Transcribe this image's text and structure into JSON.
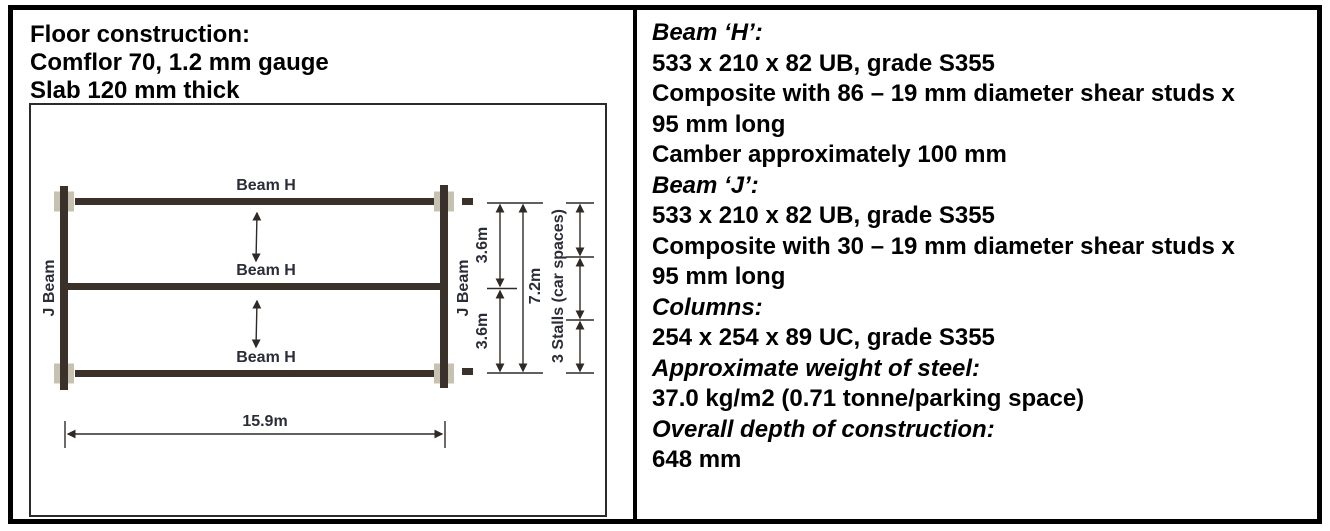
{
  "colors": {
    "beam": "#3a312a",
    "plate": "#c7c1b1",
    "line": "#2f2a26",
    "label": "#2b2e38",
    "text": "#000000"
  },
  "left_panel": {
    "header_lines": [
      "Floor construction:",
      "Comflor 70, 1.2 mm gauge",
      "Slab 120 mm thick"
    ]
  },
  "diagram": {
    "beam_h_top": "Beam H",
    "beam_h_mid": "Beam H",
    "beam_h_bottom": "Beam H",
    "j_beam_left": "J Beam",
    "j_beam_right": "J Beam",
    "dim_bay_top": "3.6m",
    "dim_bay_bottom": "3.6m",
    "dim_total_depth": "7.2m",
    "dim_stalls": "3 Stalls (car spaces)",
    "dim_width": "15.9m"
  },
  "right_panel": {
    "lines": [
      {
        "text": "Beam ‘H’:",
        "heading": true
      },
      {
        "text": "533 x 210 x 82 UB, grade S355",
        "heading": false
      },
      {
        "text": "Composite with 86 – 19 mm diameter shear studs x",
        "heading": false
      },
      {
        "text": "95 mm long",
        "heading": false
      },
      {
        "text": "Camber approximately 100 mm",
        "heading": false
      },
      {
        "text": "Beam ‘J’:",
        "heading": true
      },
      {
        "text": "533 x 210 x 82 UB, grade S355",
        "heading": false
      },
      {
        "text": "Composite with 30 – 19 mm diameter shear studs x",
        "heading": false
      },
      {
        "text": "95 mm long",
        "heading": false
      },
      {
        "text": "Columns:",
        "heading": true
      },
      {
        "text": "254 x 254 x 89 UC, grade S355",
        "heading": false
      },
      {
        "text": "Approximate weight of steel:",
        "heading": true
      },
      {
        "text": "37.0 kg/m2 (0.71 tonne/parking space)",
        "heading": false
      },
      {
        "text": "Overall depth of construction:",
        "heading": true
      },
      {
        "text": "648 mm",
        "heading": false
      }
    ]
  }
}
